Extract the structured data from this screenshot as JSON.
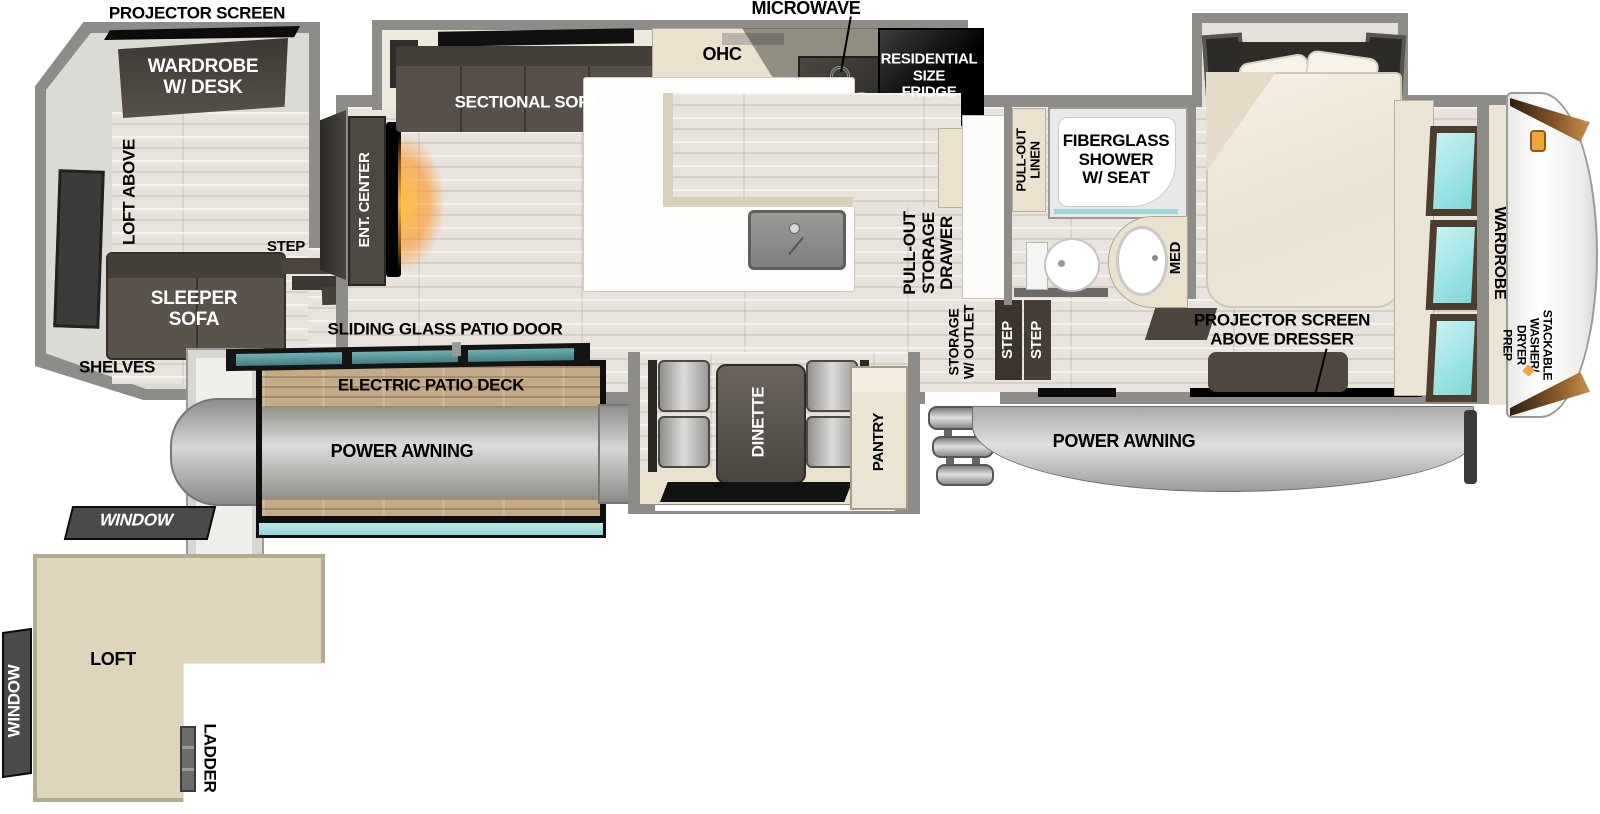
{
  "colors": {
    "wall": "#8d8c89",
    "wall_light": "#dcdad5",
    "floor_wood": "#e8e3dc",
    "cream_cabinet": "#eae2cf",
    "dark_furniture": "#55504a",
    "deck_wood": "#c3ab88",
    "teal_glass": "#57999e",
    "cyan_mirror": "#8fe2e4",
    "loft_tan": "#ded5ba",
    "awning_gray": "#c0c0be",
    "accent_orange": "#f2a33c",
    "label_black": "#000000",
    "label_white": "#ffffff"
  },
  "labels": {
    "projector_screen": "PROJECTOR SCREEN",
    "wardrobe_desk": "WARDROBE\nW/ DESK",
    "loft_above": "LOFT ABOVE",
    "sleeper_sofa": "SLEEPER\nSOFA",
    "shelves": "SHELVES",
    "step_loft_room": "STEP",
    "ent_center": "ENT. CENTER",
    "sectional_sofa": "SECTIONAL SOFA",
    "ohc": "OHC",
    "microwave": "MICROWAVE",
    "residential_fridge": "RESIDENTIAL\nSIZE\nFRIDGE",
    "pull_out_storage_drawer": "PULL-OUT\nSTORAGE\nDRAWER",
    "sliding_glass_patio_door": "SLIDING GLASS PATIO DOOR",
    "electric_patio_deck": "ELECTRIC PATIO DECK",
    "power_awning_left": "POWER AWNING",
    "power_awning_right": "POWER AWNING",
    "dinette": "DINETTE",
    "pantry": "PANTRY",
    "storage_w_outlet": "STORAGE\nW/ OUTLET",
    "step_entry_1": "STEP",
    "step_entry_2": "STEP",
    "pull_out_linen": "PULL-OUT\nLINEN",
    "fiberglass_shower": "FIBERGLASS\nSHOWER\nW/ SEAT",
    "med": "MED",
    "projector_above_dresser": "PROJECTOR SCREEN\nABOVE DRESSER",
    "wardrobe_bedroom": "WARDROBE",
    "stackable_washer_dryer": "STACKABLE\nWASHER/\nDRYER\nPREP",
    "window_top": "WINDOW",
    "window_left": "WINDOW",
    "loft": "LOFT",
    "ladder": "LADDER"
  }
}
